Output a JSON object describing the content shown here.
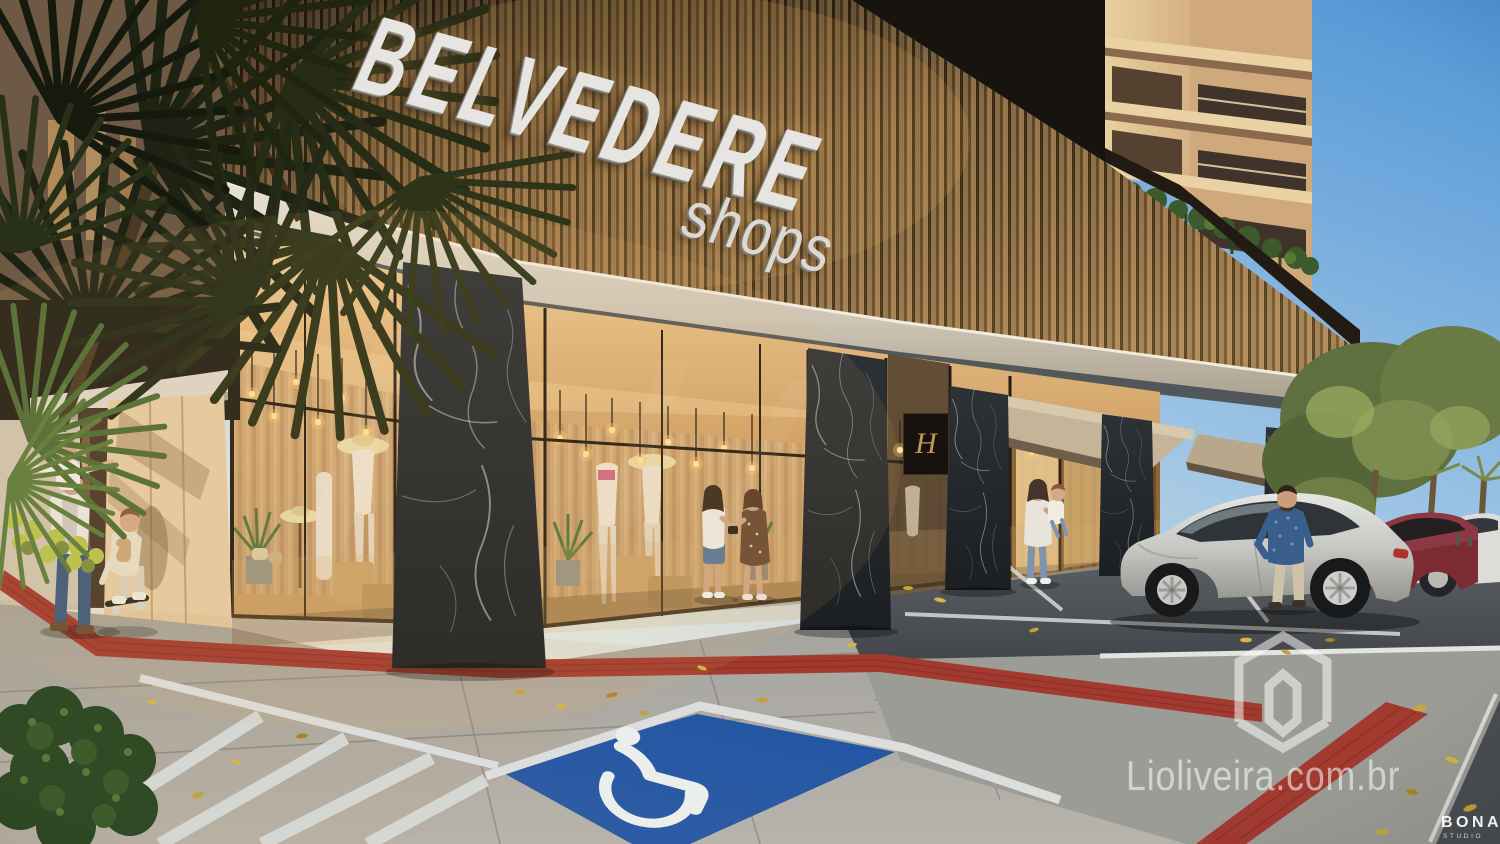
{
  "scene": {
    "type": "3d-architectural-rendering",
    "subject": "Belvedere Shops — dusk street-level view of a retail podium with residential tower, storefronts, sidewalk and parked cars",
    "elements": [
      "wood-slat facade",
      "3d sign letters",
      "black marble piers",
      "glass storefronts with mannequins",
      "awnings",
      "accessible parking marking",
      "tactile red paving",
      "silver coupe and parked cars",
      "pedestrians",
      "palm foliage",
      "watermarks"
    ]
  },
  "signage": {
    "brand": "BELVEDERE",
    "descriptor": "shops",
    "boutique_letter": "H"
  },
  "watermarks": {
    "website": "Lioliveira.com.br",
    "studio": "BONA",
    "studio_sub": "STUDIO",
    "logo": "hexagon-house-logo"
  },
  "icons": [
    {
      "name": "wheelchair-icon",
      "meaning": "accessible parking space pavement marking"
    },
    {
      "name": "hexagon-house-logo",
      "meaning": "realty brand watermark"
    }
  ],
  "colors": {
    "sky_top": "#4f95d6",
    "sky_horizon": "#efe8da",
    "wood_slats": "#a8845a",
    "fascia_band": "#d8d1c4",
    "marble_pier": "#23272a",
    "storefront_glow": "#e8bf83",
    "accessible_blue": "#1d4f9f",
    "tactile_red": "#a33a2f",
    "asphalt": "#4a4e52",
    "sidewalk": "#a8a7a2",
    "watermark_white": "rgba(255,255,255,0.55)"
  }
}
